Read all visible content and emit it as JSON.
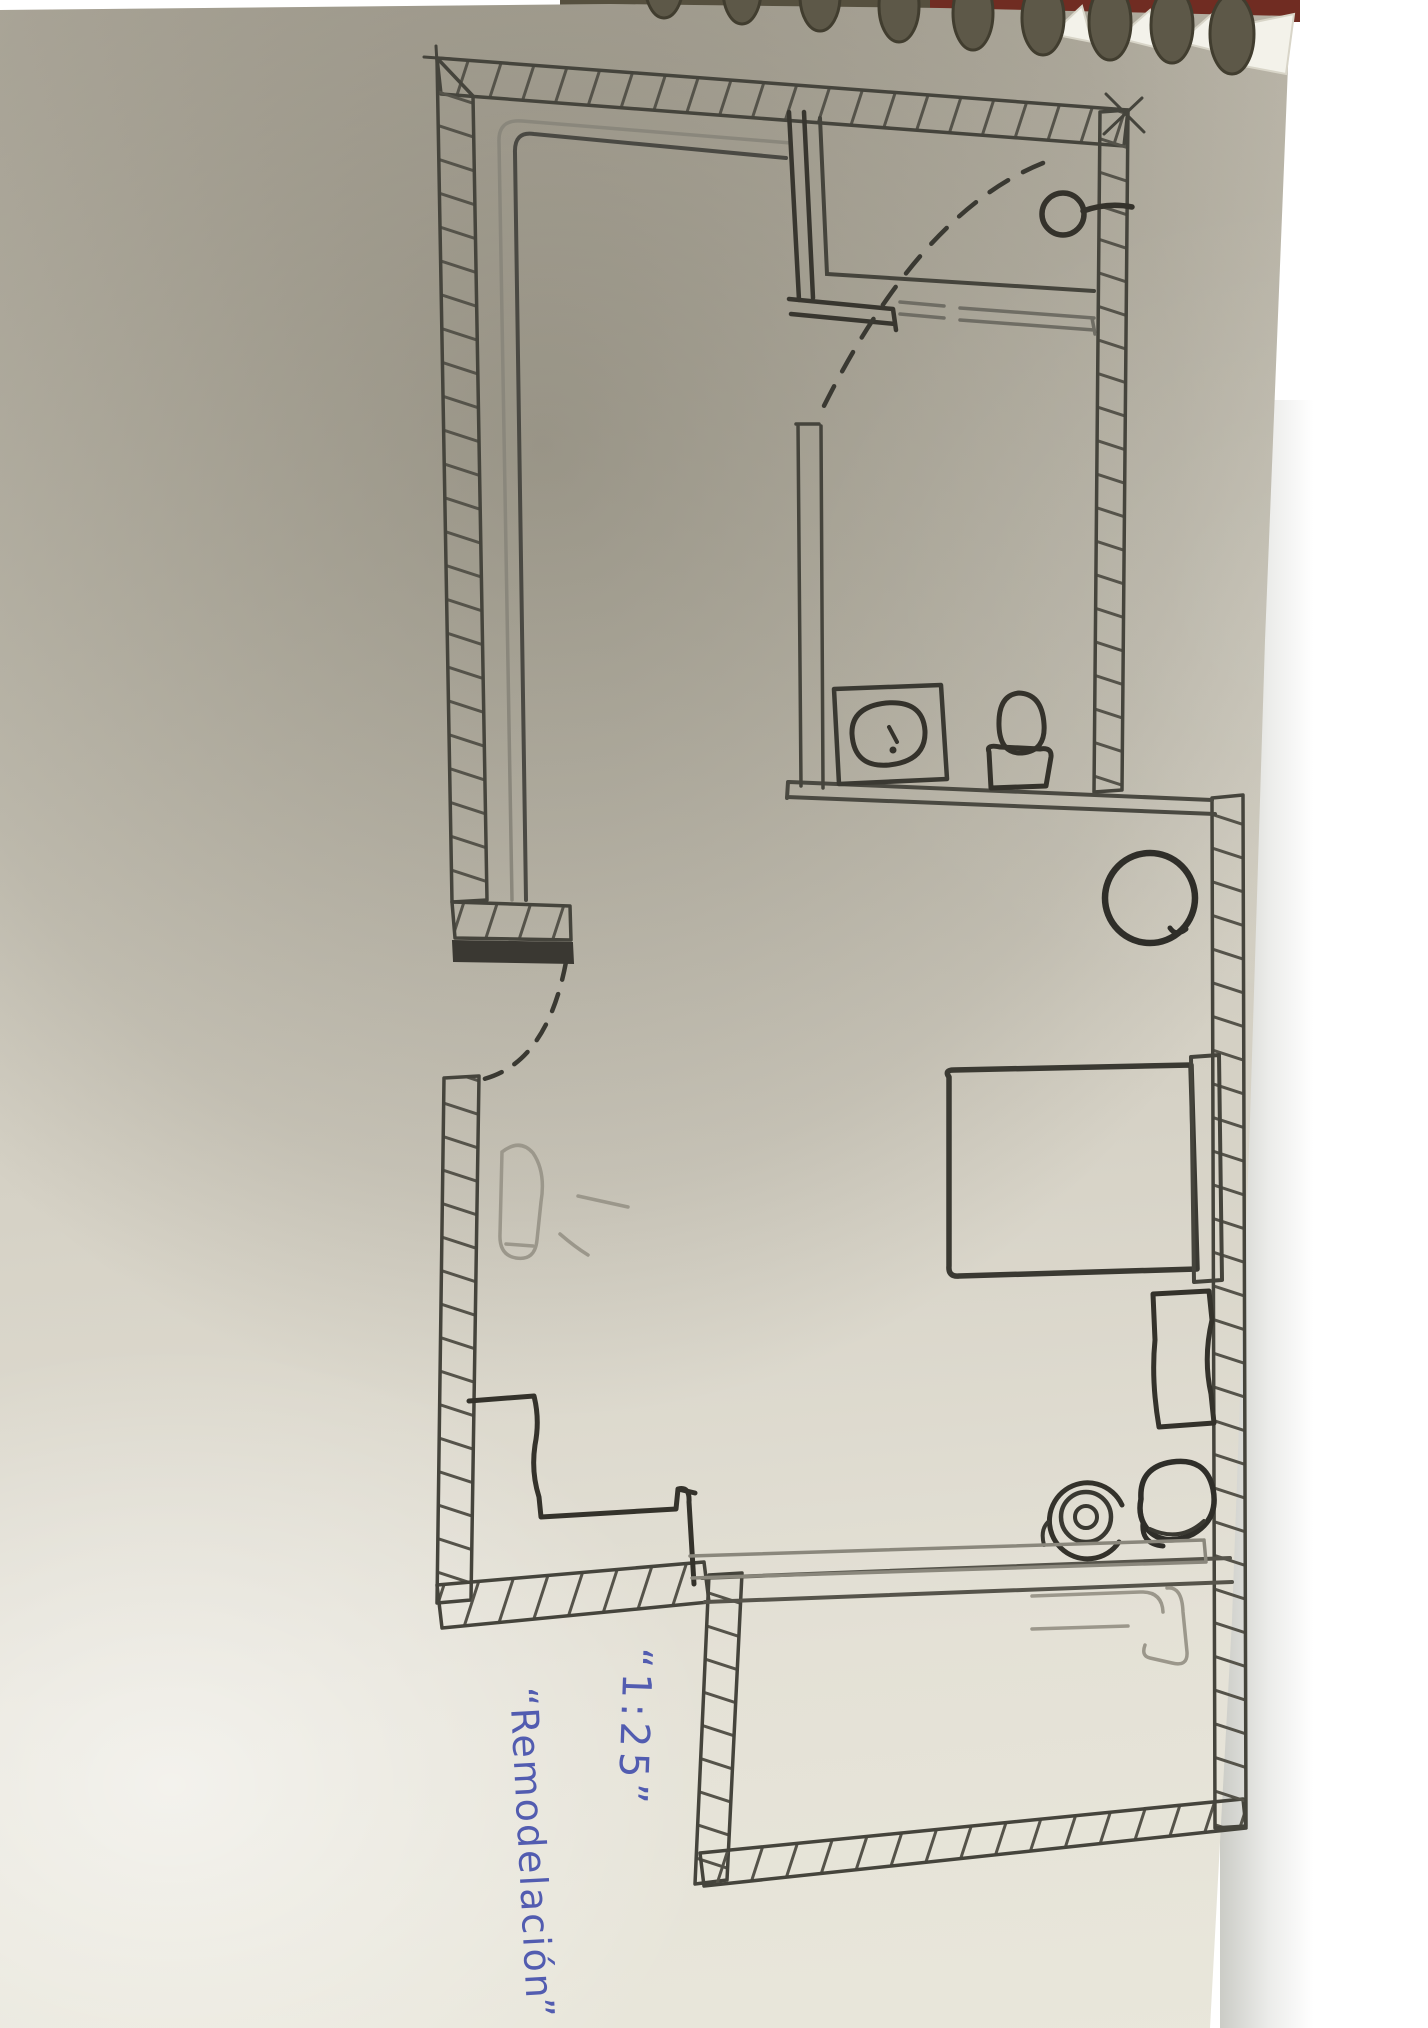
{
  "photo": {
    "background_color": "#ffffff",
    "paper_color": "#d5d1c5",
    "ink_color": "#3f3e39",
    "pencil_color": "#8a877c",
    "blue_ink_color": "#525cb0",
    "notebook": {
      "binding": "spiral",
      "coil_color": "#5d5848",
      "cover_color": "#702c22"
    }
  },
  "annotations": {
    "scale_label": "“1:25”",
    "title_label": "“Remodelación”"
  },
  "plan": {
    "rooms": [
      "main-room",
      "bathroom",
      "extension-room"
    ],
    "fixtures": [
      "closet-lining",
      "shower",
      "shower-head",
      "bathroom-sink",
      "toilet",
      "bathroom-door-swing",
      "entry-door",
      "round-stool",
      "bed",
      "headboard",
      "nightstand",
      "concentric-cup",
      "bowl",
      "l-shaped-counter",
      "counter-edge",
      "pencil-side-table",
      "pencil-extension-shape"
    ]
  }
}
